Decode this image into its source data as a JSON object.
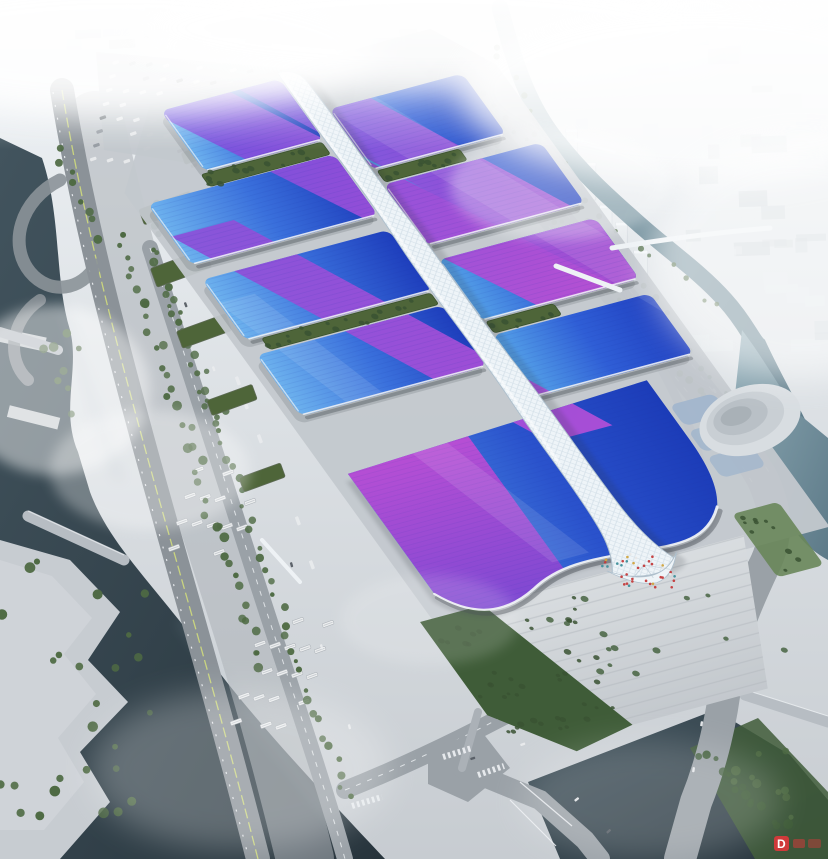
{
  "image": {
    "type": "architectural aerial rendering",
    "subject": "exhibition and convention center complex: rows of blue wave-roof halls with purple ribbon graphics, central white gridshell spine corridor, south grand hall with entrance plaza, surrounded by arterial roads, canals, parking lots and a fog-washed city"
  },
  "watermark": {
    "text": "D",
    "color": "#cf3a3a"
  },
  "palette": {
    "skyTop": "#eff3f6",
    "skyBottom": "#c7ccd1",
    "groundBase": "#c3c8cd",
    "groundLight": "#d1d5d9",
    "embankment": "#c7ccd1",
    "plazaA": "#d9dde0",
    "plazaB": "#c3c8cd",
    "roadGrey": "#9aa1a7",
    "roadDark": "#8b9298",
    "roadLight": "#abb1b7",
    "laneWhite": "#eef1f4",
    "medianYellow": "#c9d47f",
    "waterDarkA": "#42545e",
    "waterDarkB": "#27343c",
    "tealA": "#8fabb6",
    "tealB": "#5d7a88",
    "treeGreen": "#4e6a43",
    "treeDark": "#3a5232",
    "grassGreen": "#69865a",
    "palmGreen": "#3f5c38",
    "greenRoof": "#4e6539",
    "roofL1": "#6db2ee",
    "roofL2": "#3a70dc",
    "roofL3": "#1e3ebc",
    "roofR1": "#55a2e8",
    "roofR2": "#2f5ed6",
    "roofR3": "#2040c0",
    "grand1": "#4e94e6",
    "grand2": "#2a52cc",
    "grand3": "#1c3cb8",
    "rib1a": "#6f52de",
    "rib1b": "#9a4ed8",
    "rib1c": "#c050d2",
    "rib2a": "#8a4fd8",
    "rib2b": "#b44fd8",
    "purpA": "#bb4fd4",
    "purpB": "#7a48d2",
    "spineWhite": "#eef4f8",
    "spineEdge": "#aebfcc",
    "cityBlock": "#e4e9ed",
    "cityBlockShade": "#cfd6db",
    "citySlabDark": "#8e959b",
    "towerFace": "#e9edf0",
    "shadowInk": "#2a3138",
    "carWhite": "#e9ebed",
    "carGrey": "#8f969c",
    "carDark": "#565d64",
    "busWhite": "#eceeef",
    "bridgeWhite": "#eef2f5",
    "bridgeGrey": "#b7bdc3",
    "peopleRed": "#c43b3b",
    "peopleTeal": "#3f8f9a",
    "peopleYellow": "#d0a43e",
    "peopleWhite": "#e8e8e8",
    "watermarkRed": "#cf3a3a"
  }
}
